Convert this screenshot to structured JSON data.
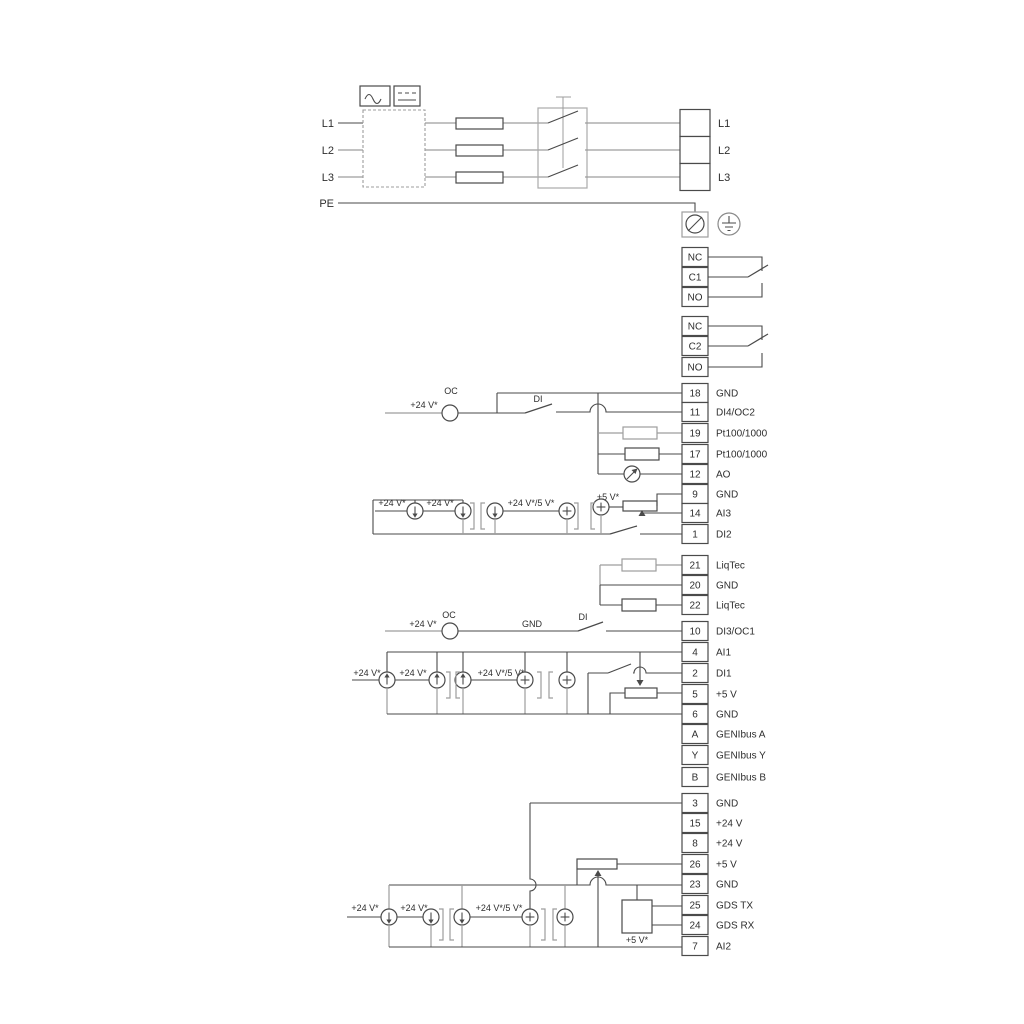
{
  "power": {
    "inputs": [
      "L1",
      "L2",
      "L3",
      "PE"
    ],
    "outputs": [
      "L1",
      "L2",
      "L3"
    ]
  },
  "relays": {
    "r1": [
      "NC",
      "C1",
      "NO"
    ],
    "r2": [
      "NC",
      "C2",
      "NO"
    ]
  },
  "labels": {
    "oc": "OC",
    "di": "DI",
    "gnd": "GND",
    "v24": "+24 V*",
    "v24v5": "+24 V*/5 V*",
    "v5": "+5 V*"
  },
  "terminals": {
    "io1": [
      {
        "n": "18",
        "l": "GND"
      },
      {
        "n": "11",
        "l": "DI4/OC2"
      },
      {
        "n": "19",
        "l": "Pt100/1000"
      },
      {
        "n": "17",
        "l": "Pt100/1000"
      },
      {
        "n": "12",
        "l": "AO"
      },
      {
        "n": "9",
        "l": "GND"
      },
      {
        "n": "14",
        "l": "AI3"
      },
      {
        "n": "1",
        "l": "DI2"
      }
    ],
    "liqtec": [
      {
        "n": "21",
        "l": "LiqTec"
      },
      {
        "n": "20",
        "l": "GND"
      },
      {
        "n": "22",
        "l": "LiqTec"
      }
    ],
    "io2": [
      {
        "n": "10",
        "l": "DI3/OC1"
      },
      {
        "n": "4",
        "l": "AI1"
      },
      {
        "n": "2",
        "l": "DI1"
      },
      {
        "n": "5",
        "l": "+5 V"
      },
      {
        "n": "6",
        "l": "GND"
      },
      {
        "n": "A",
        "l": "GENIbus A"
      },
      {
        "n": "Y",
        "l": "GENIbus Y"
      },
      {
        "n": "B",
        "l": "GENIbus B"
      }
    ],
    "io3": [
      {
        "n": "3",
        "l": "GND"
      },
      {
        "n": "15",
        "l": "+24 V"
      },
      {
        "n": "8",
        "l": "+24 V"
      },
      {
        "n": "26",
        "l": "+5 V"
      },
      {
        "n": "23",
        "l": "GND"
      },
      {
        "n": "25",
        "l": "GDS TX"
      },
      {
        "n": "24",
        "l": "GDS RX"
      },
      {
        "n": "7",
        "l": "AI2"
      }
    ]
  }
}
